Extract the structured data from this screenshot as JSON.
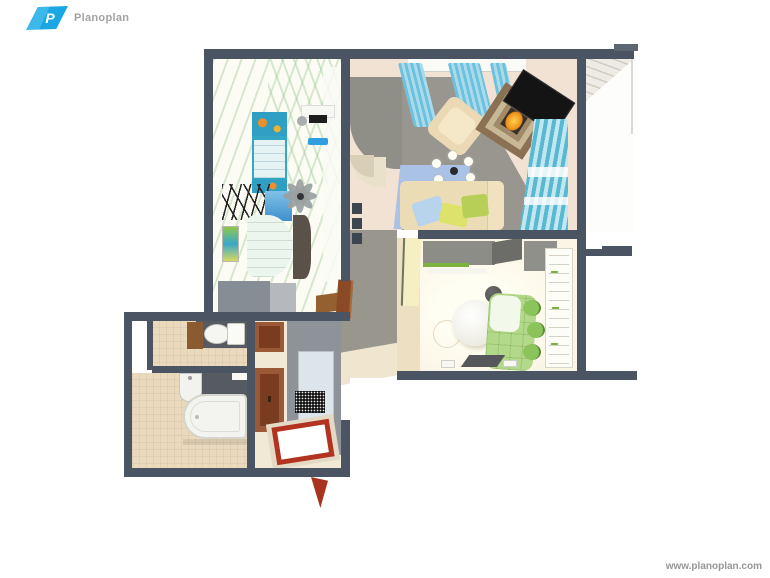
{
  "brand": {
    "logo_letter": "P",
    "logo_text": "Planoplan",
    "logo_blue": "#1ba7e3",
    "logo_text_color": "#a2a2a2"
  },
  "watermark": {
    "text": "www.planoplan.com",
    "color": "#969696"
  },
  "palette": {
    "wall": "#4a5462",
    "nursery_floor": "#fcfcf4",
    "nursery_bed_teal": "#35a6c4",
    "living_floor_peach": "#f2e2d3",
    "living_floor_gray": "#98968e",
    "curtain_teal": "#6fc0dc",
    "rug_blue": "#a9c2e6",
    "sofa_cream": "#ecdcb6",
    "pillow_blue": "#b8d4ec",
    "pillow_yellow": "#dde26a",
    "pillow_green": "#b7cf57",
    "fireplace_brown": "#8a7154",
    "fire_orange": "#f0931e",
    "kitchen_floor": "#fbf5e6",
    "banquette_green": "#b2d88a",
    "cabinet_green": "#7ab340",
    "door_wood_brown": "#9a5a38",
    "entry_mat_red": "#b23420",
    "bath_tile": "#ead9bc",
    "fixture_white": "#f3f3ef"
  },
  "scene": {
    "type": "3d-floorplan-top-down-render",
    "rooms": [
      {
        "id": "nursery",
        "furniture": [
          "kids-bed",
          "desk",
          "desk-chair",
          "blue-wall-shelf",
          "ladder-rack",
          "white-sofa",
          "ceiling-fan",
          "wall-art",
          "sideboard",
          "wardrobe"
        ]
      },
      {
        "id": "living-room",
        "furniture": [
          "kitchen-counter",
          "window-curtains",
          "armchair",
          "fireplace",
          "tv-screen",
          "chandelier",
          "blue-rug",
          "sofa-with-pillows",
          "striped-curtain",
          "wall-niches"
        ]
      },
      {
        "id": "balcony",
        "furniture": [
          "brick-ceiling",
          "glazing-edge"
        ]
      },
      {
        "id": "kitchen-diner",
        "furniture": [
          "gray-cabinets",
          "round-white-table",
          "green-banquette",
          "green-chairs",
          "ball-stool",
          "floor-tray",
          "bookshelf",
          "yellow-door"
        ]
      },
      {
        "id": "hallway",
        "furniture": [
          "wooden-door-upper",
          "wooden-door-lower",
          "white-panel",
          "black-doormat",
          "red-entry-mat",
          "open-entry-door"
        ]
      },
      {
        "id": "toilet-room",
        "furniture": [
          "toilet",
          "wood-cabinet",
          "duct-shaft"
        ]
      },
      {
        "id": "bathroom",
        "furniture": [
          "bathtub",
          "sink",
          "shelf"
        ]
      }
    ]
  }
}
